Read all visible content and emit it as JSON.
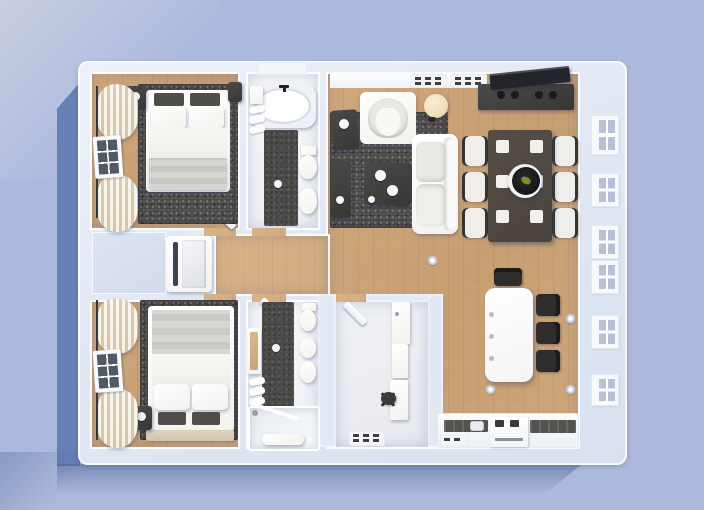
{
  "scene": {
    "type": "floor-plan-3d-render-top-view",
    "colors": {
      "background": "#adb9dc",
      "shadow": "#5e7bb2",
      "wall": "#e2e8f3",
      "wood": "#c79e72",
      "wood_light": "#d2ab80",
      "rug": "#4b4947",
      "tile": "#4d4b49",
      "bath_floor": "#eef0f4",
      "office_floor": "#e7e9ee",
      "dark_furniture": "#383736",
      "white_furniture": "#f2f1ed",
      "curtain": "#e9e0c6",
      "counter": "#55534f",
      "lamp": "#f0dfba",
      "dining_table": "#4a443d",
      "fruit_accent": "#7d8d35"
    },
    "rooms": [
      {
        "name": "bedroom-top-left",
        "furniture": [
          "double-bed",
          "dark-accent-pillows",
          "nightstand-left",
          "nightstand-right",
          "area-rug",
          "window",
          "curtains",
          "door"
        ]
      },
      {
        "name": "bathroom-top",
        "furniture": [
          "bathtub",
          "toilet",
          "bidet",
          "towel-rack",
          "bath-mat",
          "shelf",
          "window",
          "door"
        ]
      },
      {
        "name": "living-room",
        "furniture": [
          "sofa",
          "armchair",
          "coffee-table",
          "side-table",
          "console-bench",
          "floor-lamp",
          "tv",
          "tv-console",
          "area-rug",
          "floor-vents"
        ]
      },
      {
        "name": "dining-area",
        "furniture": [
          "dining-table",
          "chairs-x6",
          "placemats-x6",
          "fruit-bowl"
        ]
      },
      {
        "name": "kitchen",
        "furniture": [
          "island",
          "bar-stools-x4",
          "counter-run",
          "cooktop",
          "oven",
          "sink",
          "downlights"
        ]
      },
      {
        "name": "hallway",
        "furniture": [
          "built-in-wardrobe",
          "console-table"
        ]
      },
      {
        "name": "bedroom-bottom-left",
        "furniture": [
          "double-bed",
          "dark-accent-pillows",
          "nightstand",
          "foot-bench",
          "area-rug",
          "window",
          "curtains",
          "door"
        ]
      },
      {
        "name": "bathroom-bottom",
        "furniture": [
          "walk-in-shower",
          "toilet",
          "sink",
          "bidet",
          "vanity-mirror",
          "towel-rack",
          "bath-mat",
          "door"
        ]
      },
      {
        "name": "office-utility",
        "furniture": [
          "desk",
          "office-chair",
          "tall-cabinet",
          "cabinet",
          "radiator",
          "door"
        ]
      }
    ]
  }
}
